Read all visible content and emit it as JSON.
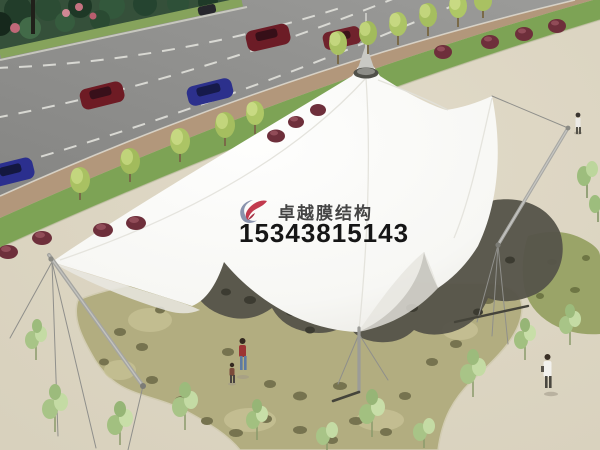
{
  "watermark": {
    "company_name": "卓越膜结构",
    "phone_number": "15343815143",
    "text_color": "#454545",
    "phone_color": "#161616",
    "logo_colors": {
      "red": "#c23a4e",
      "blue_gray": "#8a93ad"
    }
  },
  "palette": {
    "plaza_beige": "#ddd6c3",
    "road_gray": "#8f8f8d",
    "sidewalk_tan": "#b2977b",
    "grass_green": "#7da355",
    "hedge_dark_green": "#2c4a33",
    "stone_paving_olive": "#b2ad80",
    "canopy_white": "#fcfcfa",
    "canopy_shadow_olive": "#56544a",
    "car_red": "#6e1b24",
    "car_blue": "#2c308c",
    "red_shrub": "#6e2f3b",
    "sapling_green": "#a8c487",
    "mast_gray": "#a5a5a1"
  },
  "scene": {
    "type": "architectural-rendering",
    "subject": "White tensile membrane canopy structure over a stone-paved plaza",
    "elements": [
      "road with red and blue cars and dashed lane lines",
      "dark hedge and street trees along sidewalk",
      "multi-peak white membrane canopy with central cone and finial",
      "leaning steel masts with tension cables",
      "olive stone paving with scattered dark stones",
      "green saplings and red shrubs",
      "pedestrians including woman with child"
    ]
  }
}
